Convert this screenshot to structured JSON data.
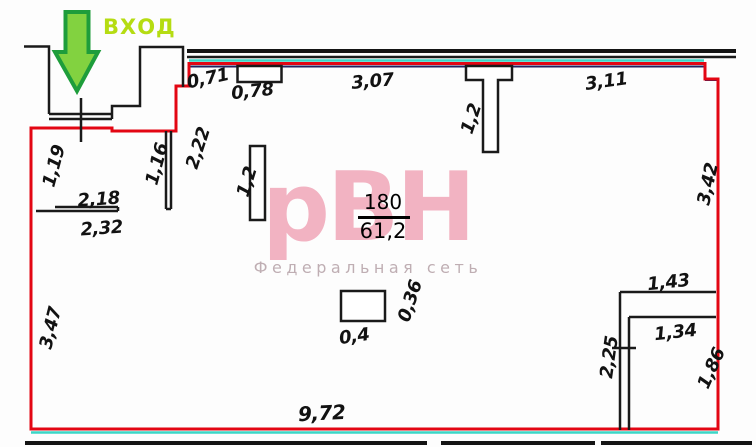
{
  "plan": {
    "room_number": "180",
    "room_area": "61,2",
    "entrance_label": "ВХОД"
  },
  "watermark": {
    "logo": "рВН",
    "subtitle": "Федеральная сеть"
  },
  "dims": [
    {
      "text": "0,71"
    },
    {
      "text": "0,78"
    },
    {
      "text": "3,07"
    },
    {
      "text": "3,11"
    },
    {
      "text": "1,2"
    },
    {
      "text": "2,22"
    },
    {
      "text": "1,19"
    },
    {
      "text": "1,16"
    },
    {
      "text": "2,18"
    },
    {
      "text": "2,32"
    },
    {
      "text": "1,2"
    },
    {
      "text": "3,42"
    },
    {
      "text": "3,47"
    },
    {
      "text": "0,4"
    },
    {
      "text": "0,36"
    },
    {
      "text": "1,43"
    },
    {
      "text": "1,34"
    },
    {
      "text": "2,25"
    },
    {
      "text": "1,86"
    },
    {
      "text": "9,72"
    }
  ],
  "colors": {
    "boundary_red": "#e30613",
    "wall_black": "#1a1a1a",
    "utility_cyan": "#3bd6c6",
    "utility_navy": "#232360",
    "arrow_green_fill": "#82d240",
    "arrow_green_border": "#1e9d3b",
    "entrance_text_green": "#b5dc12",
    "watermark_pink": "#f0a3b6",
    "watermark_subtitle_gray": "#bfaeb3"
  }
}
